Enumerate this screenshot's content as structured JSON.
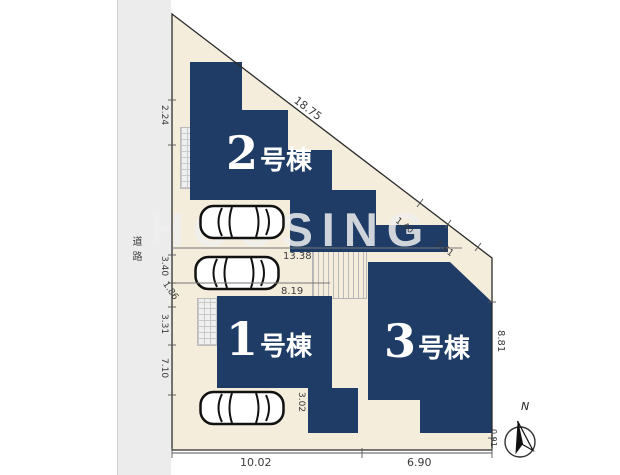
{
  "scene": {
    "road_label": "道路",
    "watermark_text": "HOUSING",
    "compass_n": "N"
  },
  "buildings": {
    "b1": {
      "number": "1",
      "suffix": "号棟"
    },
    "b2": {
      "number": "2",
      "suffix": "号棟"
    },
    "b3": {
      "number": "3",
      "suffix": "号棟"
    }
  },
  "dims": {
    "hypotenuse": "18.75",
    "diag_a": "1.40",
    "diag_b": "2.61",
    "width_upper": "13.38",
    "width_lower": "8.19",
    "right_height": "8.81",
    "bottom_left": "10.02",
    "bottom_right": "6.90",
    "corner_right": "0.91",
    "left_top": "2.24",
    "left_a": "3.40",
    "left_b": "1.86",
    "left_c": "3.31",
    "left_d": "7.10",
    "inner_vertical": "3.02"
  },
  "colors": {
    "building": "#1e3c66",
    "lot": "#f4eddc",
    "road": "#ececec"
  }
}
